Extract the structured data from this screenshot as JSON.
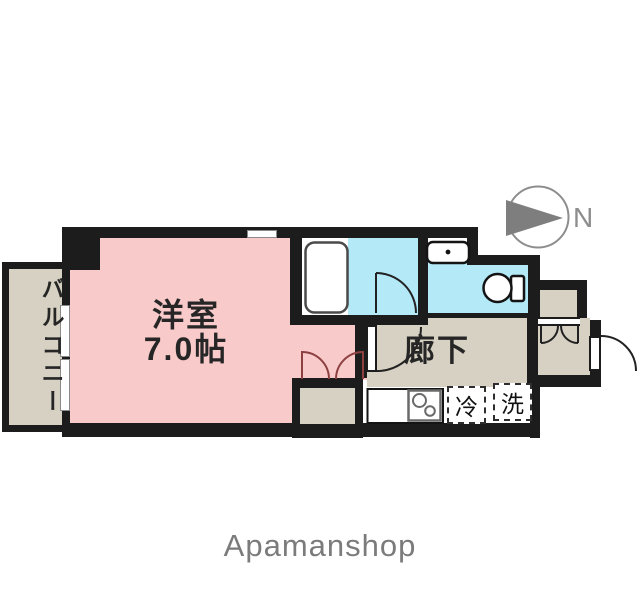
{
  "floorplan": {
    "main_room": {
      "name_label": "洋室",
      "size_label": "7.0帖"
    },
    "corridor": {
      "label": "廊下"
    },
    "balcony": {
      "label": "バルコニー"
    },
    "appliances": {
      "fridge_label": "冷",
      "washer_label": "洗"
    },
    "compass": {
      "direction_label": "N"
    },
    "colors": {
      "room_pink": "#f9caca",
      "bath_cyan": "#b4e9f8",
      "floor_beige": "#d6d1c2",
      "wall_black": "#1c1c1c",
      "closet_door_maroon": "#8d4040",
      "compass_gray": "#8d8d8d"
    }
  },
  "footer": {
    "watermark": "Apamanshop"
  }
}
